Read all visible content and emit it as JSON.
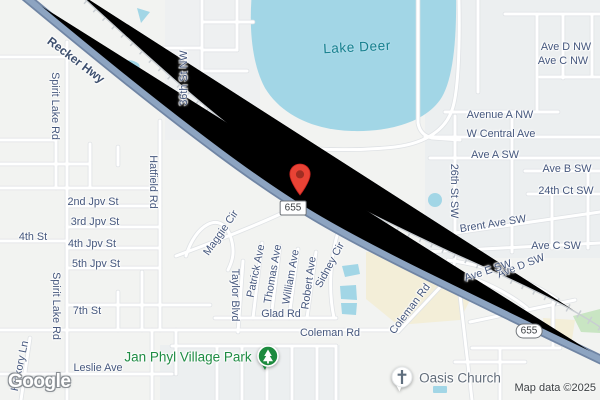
{
  "map": {
    "logo": "Google",
    "attribution": "Map data ©2025",
    "colors": {
      "land": "#f2f3f1",
      "water": "#a2d6e6",
      "highway": "#8da4c1",
      "commercial": "#f3eed8",
      "park_green": "#c9e5c3",
      "road_label": "#45577d",
      "water_label": "#17808f",
      "park_label": "#1f8c44",
      "poi_label": "#636e7b",
      "pin_red": "#e94335"
    },
    "water_labels": [
      {
        "text": "Lake Deer"
      }
    ],
    "route_shields": [
      {
        "text": "655"
      },
      {
        "text": "655"
      }
    ],
    "marker": {
      "name": "dropped-pin"
    },
    "pois": [
      {
        "name": "Jan Phyl Village Park",
        "icon": "park-tree-icon"
      },
      {
        "name": "Oasis Church",
        "icon": "church-cross-icon"
      }
    ],
    "road_labels": [
      {
        "text": "Recker Hwy"
      },
      {
        "text": "Spirit Lake Rd"
      },
      {
        "text": "36th St NW"
      },
      {
        "text": "Hatfield Rd"
      },
      {
        "text": "2nd Jpv St"
      },
      {
        "text": "3rd Jpv St"
      },
      {
        "text": "4th St"
      },
      {
        "text": "4th Jpv St"
      },
      {
        "text": "5th Jpv St"
      },
      {
        "text": "Spirit Lake Rd"
      },
      {
        "text": "7th St"
      },
      {
        "text": "Leslie Ave"
      },
      {
        "text": "Hickory Ln"
      },
      {
        "text": "Maggie Cir"
      },
      {
        "text": "Taylor Blvd"
      },
      {
        "text": "Patrick Ave"
      },
      {
        "text": "Thomas Ave"
      },
      {
        "text": "William Ave"
      },
      {
        "text": "Robert Ave"
      },
      {
        "text": "Sidney Cir"
      },
      {
        "text": "Glad Rd"
      },
      {
        "text": "Coleman Rd"
      },
      {
        "text": "Coleman Rd"
      },
      {
        "text": "Ave D NW"
      },
      {
        "text": "Ave C NW"
      },
      {
        "text": "Avenue A NW"
      },
      {
        "text": "W Central Ave"
      },
      {
        "text": "Ave A SW"
      },
      {
        "text": "Ave B SW"
      },
      {
        "text": "24th Ct SW"
      },
      {
        "text": "26th St SW"
      },
      {
        "text": "Brent Ave SW"
      },
      {
        "text": "Ave C SW"
      },
      {
        "text": "Ave D SW"
      },
      {
        "text": "Ave E SW"
      }
    ]
  }
}
